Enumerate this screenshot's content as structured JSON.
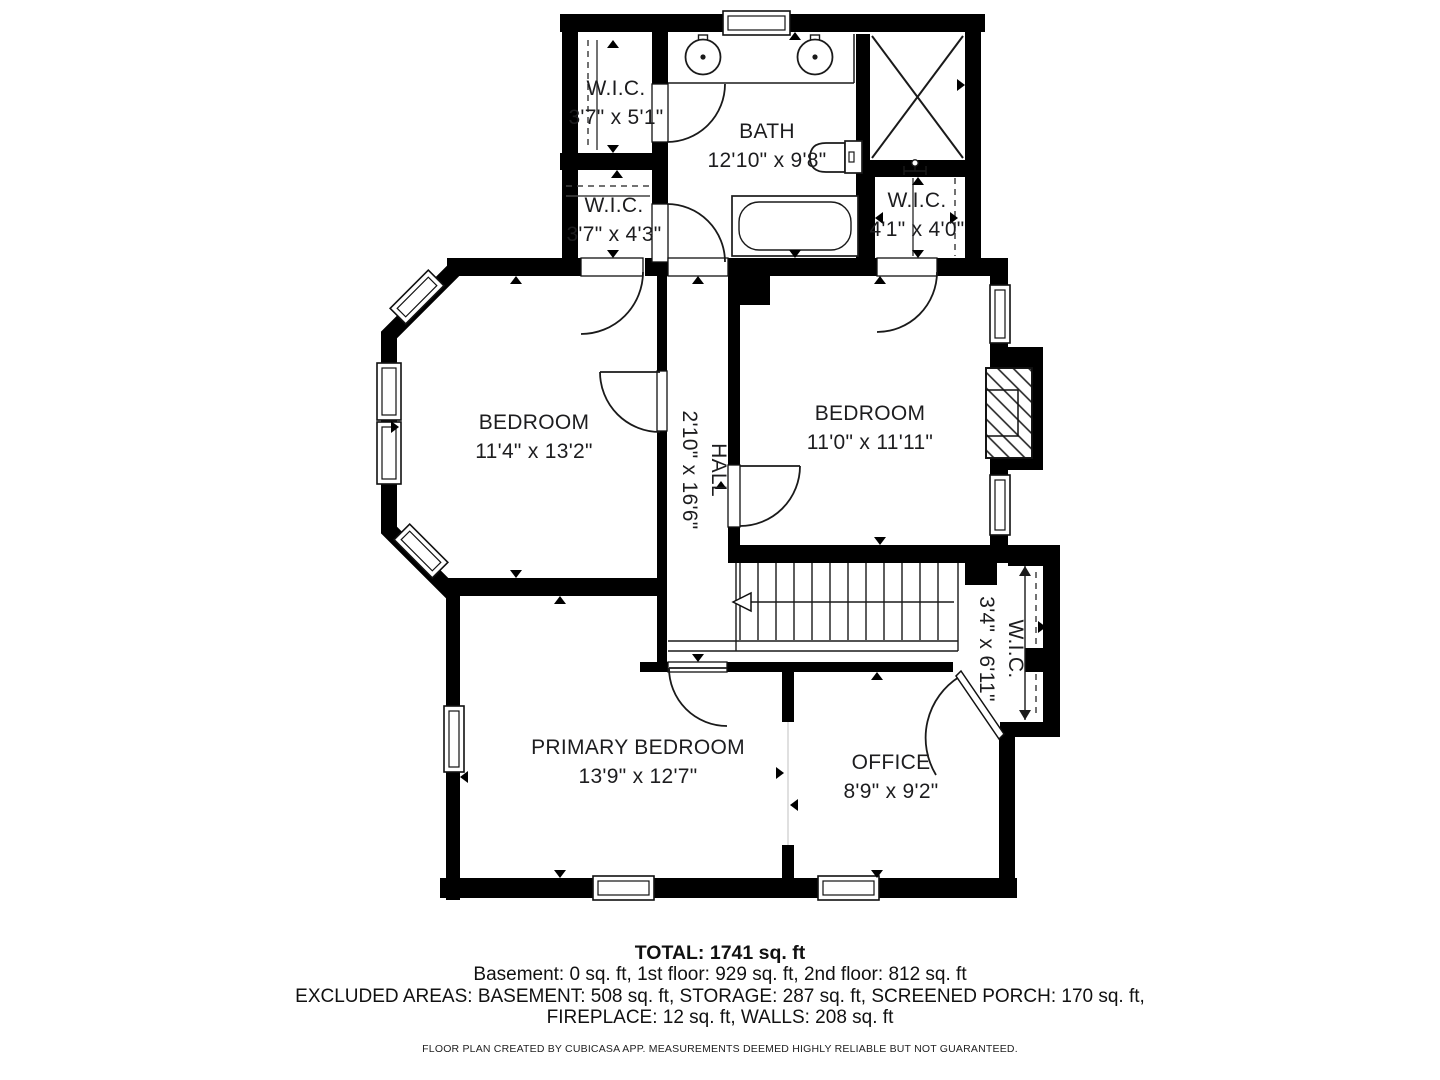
{
  "colors": {
    "wall": "#000000",
    "text": "#1d1d1f",
    "background": "#ffffff"
  },
  "rooms": {
    "wic_top_left": {
      "name": "W.I.C.",
      "dims": "3'7\" x 5'1\""
    },
    "wic_mid_left": {
      "name": "W.I.C.",
      "dims": "3'7\" x 4'3\""
    },
    "bath": {
      "name": "BATH",
      "dims": "12'10\" x 9'8\""
    },
    "wic_right": {
      "name": "W.I.C.",
      "dims": "4'1\" x 4'0\""
    },
    "bedroom_left": {
      "name": "BEDROOM",
      "dims": "11'4\" x 13'2\""
    },
    "hall": {
      "name": "HALL",
      "dims": "2'10\" x 16'6\""
    },
    "bedroom_right": {
      "name": "BEDROOM",
      "dims": "11'0\" x 11'11\""
    },
    "wic_lower_right": {
      "name": "W.I.C.",
      "dims": "3'4\" x 6'11\""
    },
    "primary_bedroom": {
      "name": "PRIMARY BEDROOM",
      "dims": "13'9\" x 12'7\""
    },
    "office": {
      "name": "OFFICE",
      "dims": "8'9\" x 9'2\""
    }
  },
  "summary": {
    "total": "TOTAL: 1741 sq. ft",
    "floors": "Basement: 0 sq. ft, 1st floor: 929 sq. ft, 2nd floor: 812 sq. ft",
    "excluded_line1": "EXCLUDED AREAS: BASEMENT: 508 sq. ft, STORAGE: 287 sq. ft, SCREENED PORCH: 170 sq. ft,",
    "excluded_line2": "FIREPLACE: 12 sq. ft, WALLS: 208 sq. ft"
  },
  "disclaimer": "FLOOR PLAN CREATED BY CUBICASA APP. MEASUREMENTS DEEMED HIGHLY RELIABLE BUT NOT GUARANTEED."
}
